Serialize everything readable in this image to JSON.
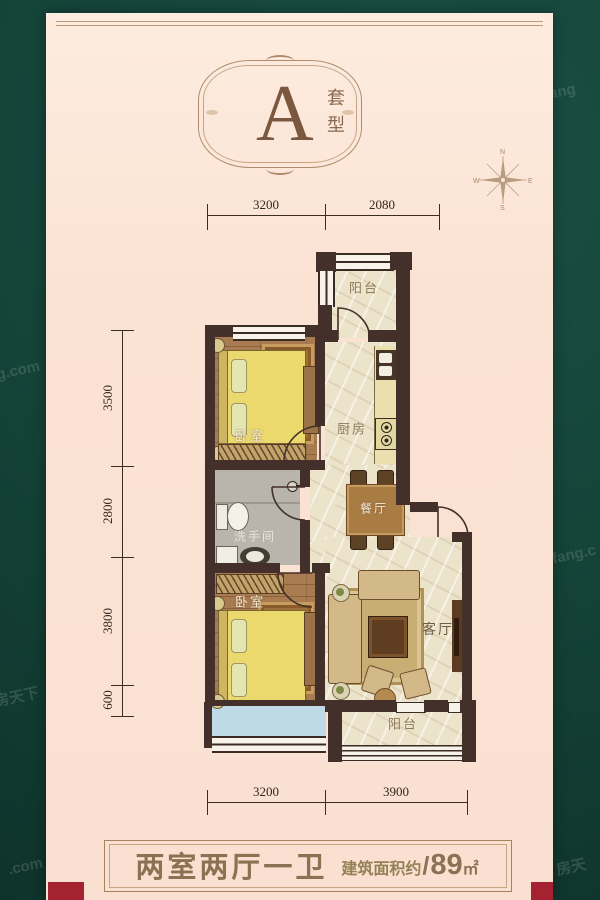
{
  "poster": {
    "emblem": {
      "letter": "A",
      "label": "套型"
    },
    "compass": {
      "north": "N",
      "south": "S",
      "east": "E",
      "west": "W"
    },
    "dimensions": {
      "top": [
        "3200",
        "2080"
      ],
      "left": [
        "3500",
        "2800",
        "3800",
        "600"
      ],
      "bottom": [
        "3200",
        "3900"
      ]
    },
    "rooms": {
      "balcony_top": "阳台",
      "bedroom_top": "卧室",
      "kitchen": "厨房",
      "dining": "餐厅",
      "bathroom": "洗手间",
      "bedroom_bottom": "卧室",
      "living": "客厅",
      "balcony_bottom": "阳台"
    },
    "footer": {
      "layout": "两室两厅一卫",
      "area_label": "建筑面积约",
      "separator": "/",
      "area_value": "89",
      "area_unit": "㎡"
    },
    "watermarks": [
      "Fang",
      "g.com",
      "房天下",
      "fang.c",
      ".com",
      "房天"
    ],
    "colors": {
      "background_green": "#14453b",
      "card_pink": "#fbe3d4",
      "wall_brown": "#44302a",
      "accent_brown": "#8b7253",
      "ribbon_red": "#a52230"
    }
  }
}
